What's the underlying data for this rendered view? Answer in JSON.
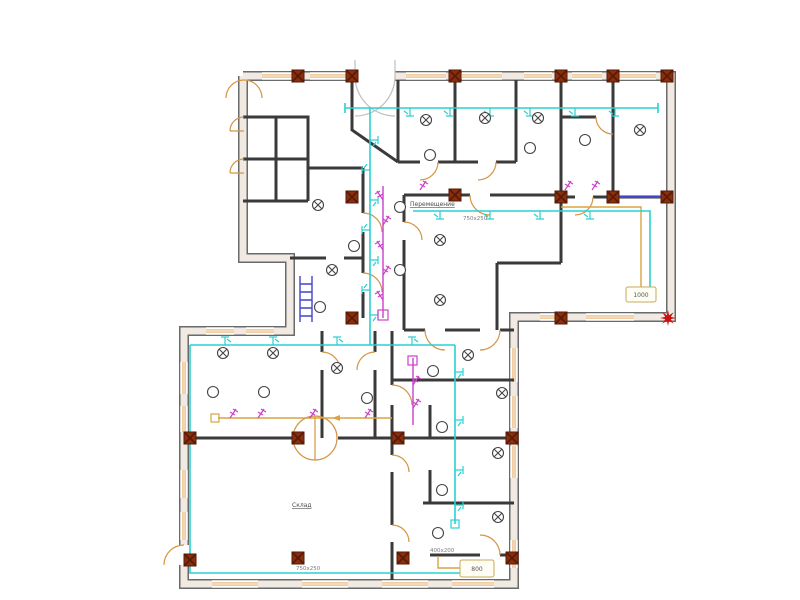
{
  "meta": {
    "type": "floor-plan",
    "description": "CAD electrical/ventilation floor plan of a two-wing building"
  },
  "labels": {
    "relocation_note": {
      "text": "Перемещение"
    },
    "storage_room": {
      "text": "Склад"
    },
    "duct_size_top": {
      "text": "750х250"
    },
    "duct_size_bottom": {
      "text": "750х250"
    },
    "duct_size_small": {
      "text": "400х200"
    },
    "terminal_right": {
      "text": "1000"
    },
    "terminal_bottom": {
      "text": "800"
    }
  },
  "colors": {
    "outer_wall_outline": "#6a6a6a",
    "outer_wall_fill": "#f0eae3",
    "interior_wall": "#3a3a3a",
    "window": "#e09a40",
    "door_arc": "#d49544",
    "entrance_door": "#c2c2c2",
    "wiring_cyan": "#2ad0d0",
    "circuit_magenta": "#cc3fcc",
    "duct_tan": "#d9a441",
    "column_red": "#8b2e0e",
    "accent_blue": "#4444c8",
    "corner_marker_red": "#cc1111",
    "symbol_stroke": "#444444"
  },
  "symbols": {
    "ceiling_lamp": "circle with X cross",
    "wall_outlet": "plain circle",
    "column": "dark red square with X",
    "wiring_tap": "cyan tee tick",
    "switch": "magenta flag"
  }
}
